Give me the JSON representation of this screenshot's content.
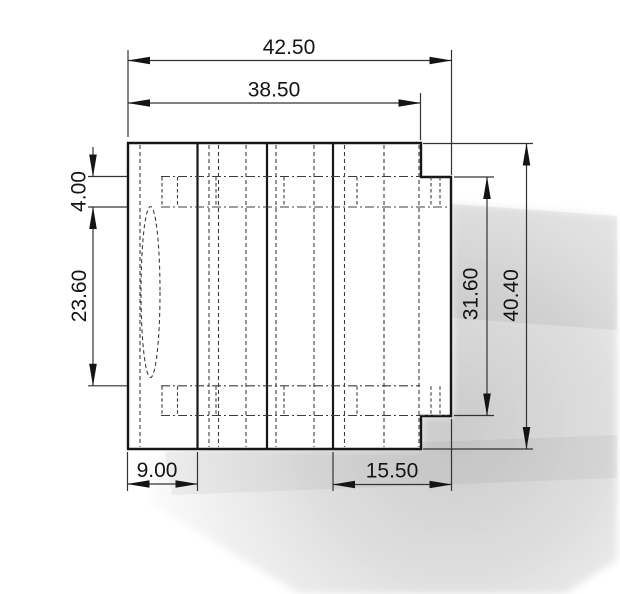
{
  "drawing": {
    "title": "part-orthographic-view",
    "dimensions": {
      "overall_width": "42.50",
      "inner_width": "38.50",
      "top_offset": "4.00",
      "left_height": "23.60",
      "right_inner_height": "31.60",
      "overall_height": "40.40",
      "bottom_left_width": "9.00",
      "bottom_right_width": "15.50"
    },
    "colors": {
      "line": "#161616",
      "dimension_line": "#333333",
      "hidden_line": "#3c3c3c",
      "background": "#ffffff",
      "shadow_core": "#cbcbcb",
      "shadow_edge": "#f9f9f9"
    }
  }
}
